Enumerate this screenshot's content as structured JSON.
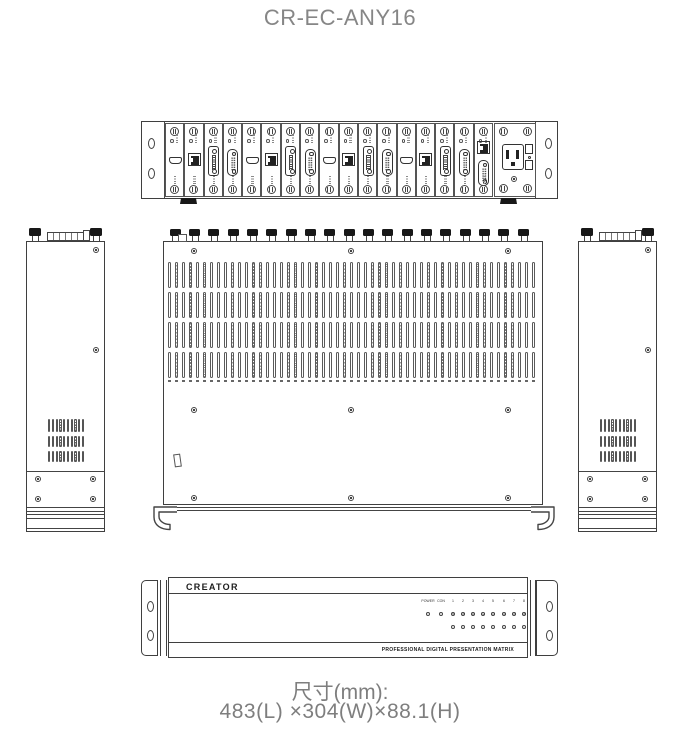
{
  "title": "CR-EC-ANY16",
  "rear_panel": {
    "slots": [
      "hdmi",
      "rj45",
      "dvi",
      "vga",
      "hdmi",
      "rj45",
      "dvi",
      "vga",
      "hdmi",
      "rj45",
      "dvi",
      "vga",
      "hdmi",
      "rj45",
      "dvi",
      "vga",
      "control"
    ],
    "has_power_module": true
  },
  "top_panel": {
    "thumbscrew_knobs": 19,
    "vent_rows": 4,
    "vent_columns": 53,
    "dash_columns": 53,
    "screw_rows": 3,
    "screws_per_row": 3
  },
  "side_panel": {
    "vent_rows": 3,
    "vent_columns": 10,
    "corner_screws": 4
  },
  "front_panel": {
    "brand": "CREATOR",
    "led_row_top": [
      "POWER",
      "CON",
      "1",
      "2",
      "3",
      "4",
      "5",
      "6",
      "7",
      "8"
    ],
    "led_row_bottom": [
      "9",
      "10",
      "11",
      "12",
      "13",
      "14",
      "15",
      "16"
    ],
    "footer": "PROFESSIONAL DIGITAL PRESENTATION MATRIX"
  },
  "dimensions": {
    "label": "尺寸(mm):",
    "value": "483(L) ×304(W)×88.1(H)"
  }
}
